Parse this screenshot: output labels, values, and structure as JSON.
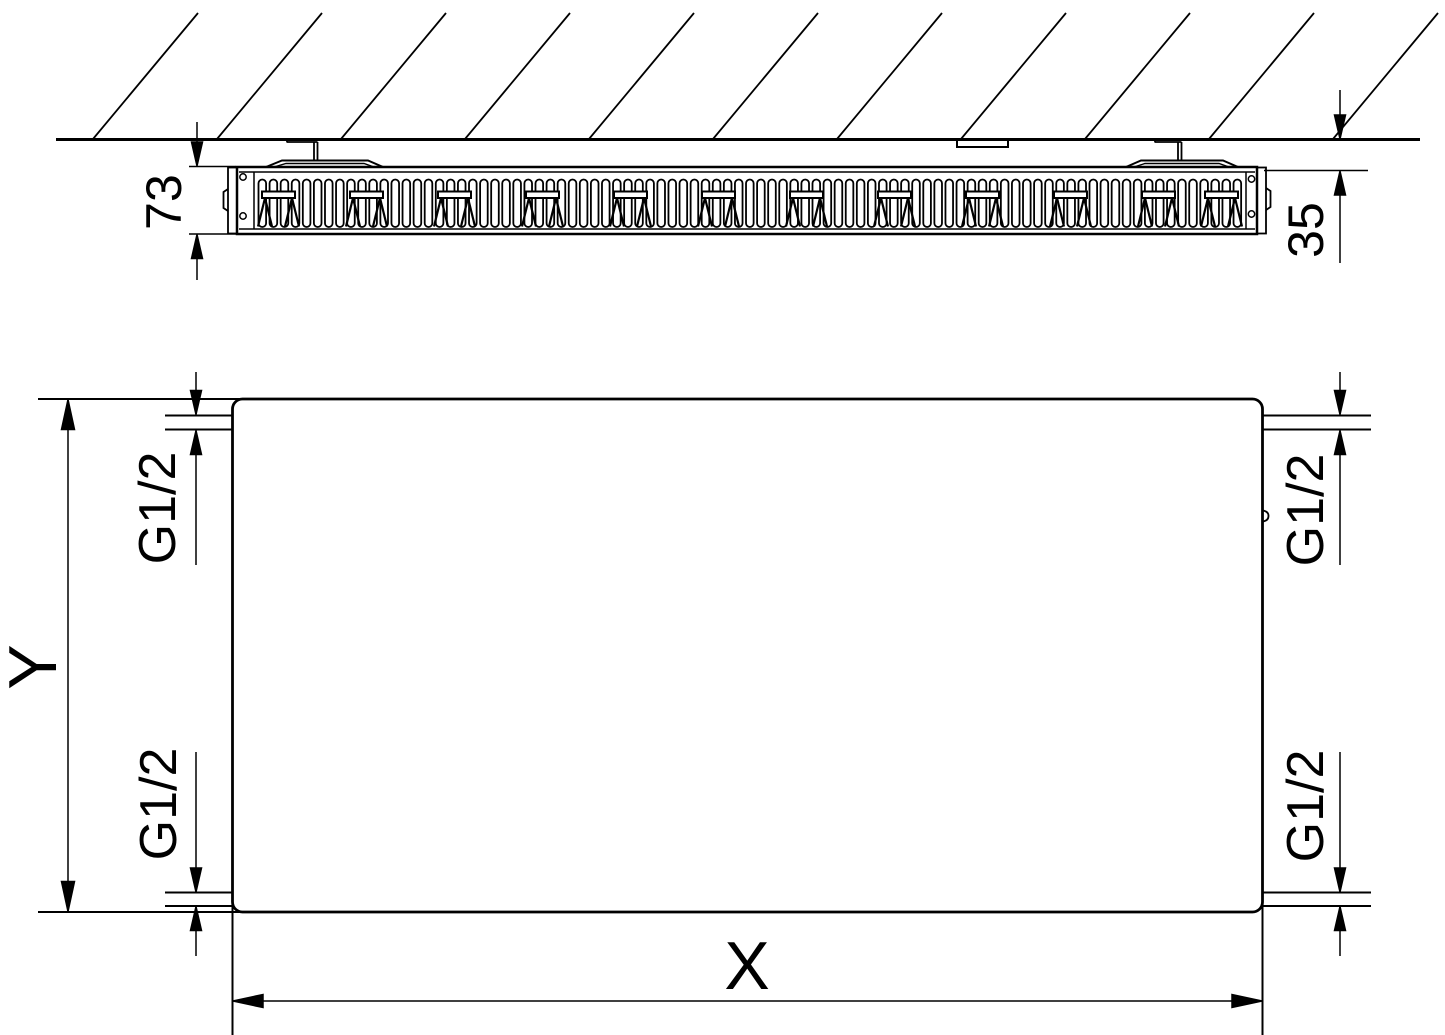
{
  "colors": {
    "line": "#000000",
    "background": "#ffffff"
  },
  "top_view": {
    "depth_label": "73",
    "wall_distance_label": "35"
  },
  "front_view": {
    "width_label": "X",
    "height_label": "Y",
    "connections": {
      "top_left": "G1/2",
      "top_right": "G1/2",
      "bottom_left": "G1/2",
      "bottom_right": "G1/2"
    }
  }
}
